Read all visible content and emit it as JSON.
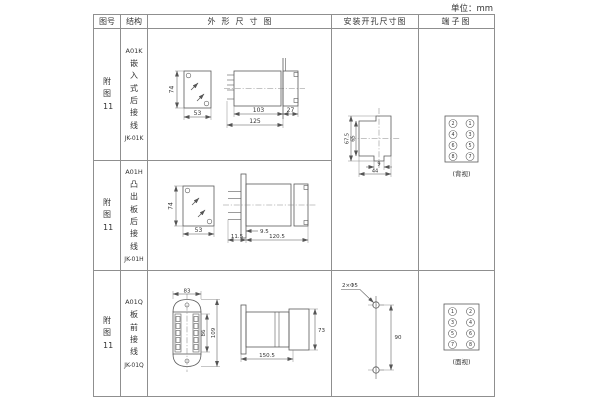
{
  "unit_label": "单位：mm",
  "table": {
    "headers": [
      "图号",
      "结构",
      "外形尺寸图",
      "安装开孔尺寸图",
      "端子图"
    ],
    "rows": [
      {
        "figure_no": "附图11",
        "structure": {
          "model": "A01K",
          "desc": "嵌入式后接线",
          "code": "JK-01K"
        },
        "dims": {
          "height": "74",
          "width": "53",
          "body": "103",
          "total": "125",
          "rear": "27"
        }
      },
      {
        "figure_no": "附图11",
        "structure": {
          "model": "A01H",
          "desc": "凸出板后接线",
          "code": "JK-01H"
        },
        "dims": {
          "height": "74",
          "width": "53",
          "offset": "9.5",
          "front": "11.5",
          "body": "120.5"
        }
      },
      {
        "figure_no": "附图11",
        "structure": {
          "model": "A01Q",
          "desc": "板前接线",
          "code": "JK-01Q"
        },
        "dims": {
          "width": "83",
          "inner_height": "86",
          "outer_height": "109",
          "side_height": "73",
          "length": "150.5"
        }
      }
    ],
    "cutout": {
      "outer_height": "67.5",
      "inner_height": "65",
      "notch_width": "9",
      "width": "44"
    },
    "drill": {
      "label": "2×Φ5",
      "spacing": "90"
    },
    "terminals": {
      "rear": {
        "left": [
          "2",
          "4",
          "6",
          "8"
        ],
        "right": [
          "1",
          "3",
          "5",
          "7"
        ],
        "view": "(背视)"
      },
      "front": {
        "left": [
          "1",
          "3",
          "5",
          "7"
        ],
        "right": [
          "2",
          "4",
          "6",
          "8"
        ],
        "view": "(面视)"
      }
    }
  }
}
